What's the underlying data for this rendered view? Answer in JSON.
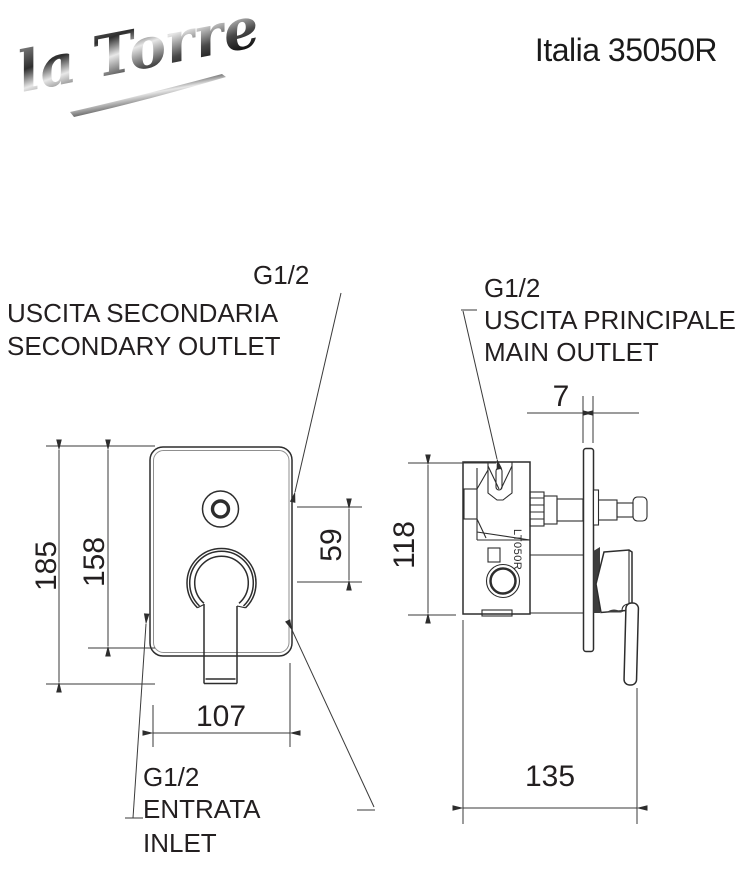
{
  "brand": {
    "logo_text": "la Torre"
  },
  "header": {
    "title": "Italia 35050R"
  },
  "labels": {
    "secondary_outlet": {
      "thread": "G1/2",
      "line1": "USCITA SECONDARIA",
      "line2": "SECONDARY OUTLET"
    },
    "main_outlet": {
      "thread": "G1/2",
      "line1": "USCITA PRINCIPALE",
      "line2": "MAIN OUTLET"
    },
    "inlet": {
      "thread": "G1/2",
      "line1": "ENTRATA",
      "line2": "INLET"
    }
  },
  "dimensions_mm": {
    "front_total_height": "185",
    "front_plate_height": "158",
    "outlet_to_handle_offset": "59",
    "plate_width": "107",
    "side_body_height": "118",
    "plate_thickness": "7",
    "side_total_depth": "135"
  },
  "drawing": {
    "cartridge_marking": "LT050R"
  },
  "colors": {
    "line": "#2d2d2d",
    "text": "#231f20",
    "metal_dark": "#3a3a3a"
  }
}
